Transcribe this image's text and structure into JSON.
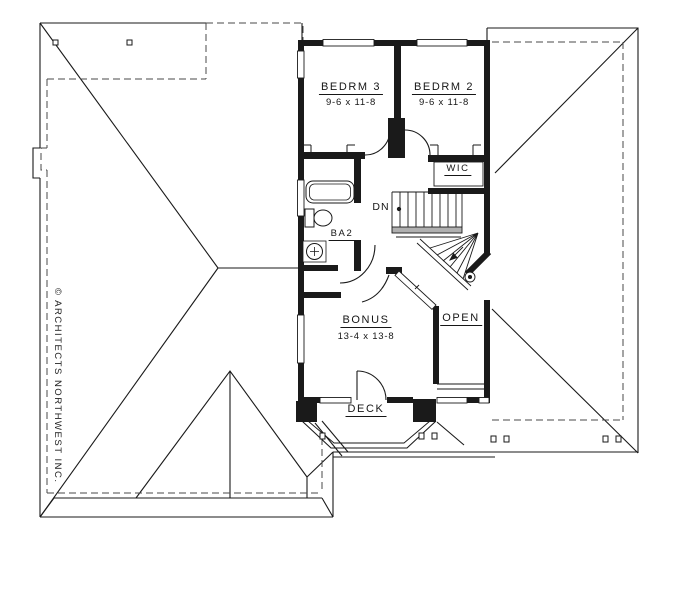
{
  "plan": {
    "rooms": {
      "bedrm3": {
        "name": "BEDRM 3",
        "dims": "9-6 x 11-8"
      },
      "bedrm2": {
        "name": "BEDRM 2",
        "dims": "9-6 x 11-8"
      },
      "wic": {
        "name": "WIC"
      },
      "ba2": {
        "name": "BA2"
      },
      "bonus": {
        "name": "BONUS",
        "dims": "13-4 x 13-8"
      },
      "open": {
        "name": "OPEN"
      },
      "deck": {
        "name": "DECK"
      }
    },
    "stairs": {
      "direction_label": "DN"
    },
    "copyright": "© ARCHITECTS NORTHWEST INC.",
    "colors": {
      "line": "#1a1a1a",
      "rail_fill": "#b0b0b0",
      "background": "#ffffff"
    }
  }
}
